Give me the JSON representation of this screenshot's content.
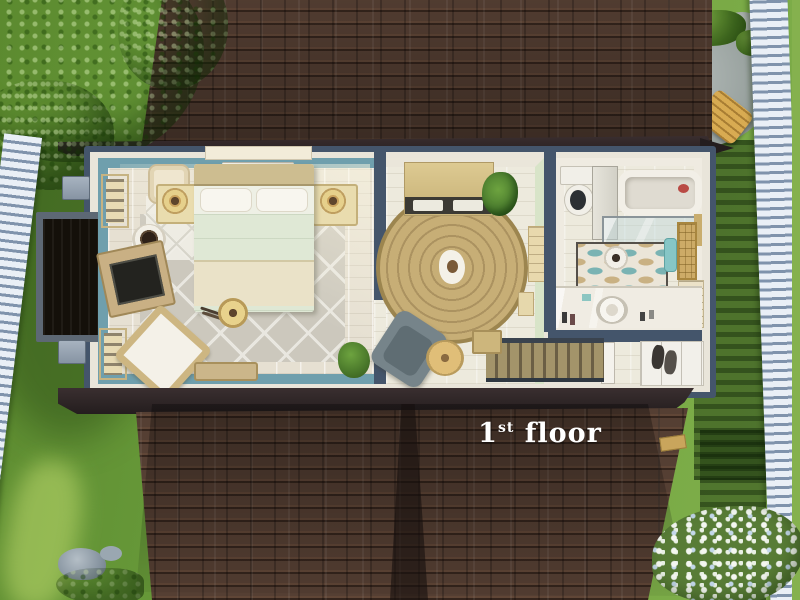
{
  "label": {
    "number": "1",
    "sup": "st",
    "word": " floor",
    "full_text": "1st floor"
  },
  "scene": {
    "description": "Top-down cutaway floorplan view of a house first floor in a life-sim game",
    "floor_shown": "1st floor"
  },
  "palette": {
    "roof_shingle": "#553f33",
    "roof_eave": "#2d2425",
    "grass": "#6f9e3a",
    "wall_cut_navy": "#44556b",
    "bedroom_wall_teal": "#6f9fad",
    "mint_wall": "#d8e4c8",
    "exterior_trim": "#e9e5da",
    "fence_white": "#e9eff6",
    "rug_tan": "#c7ae76",
    "stair_wood": "#9a8c60",
    "label_text": "#ffffff"
  },
  "rooms": [
    {
      "name": "bedroom",
      "wall_color": "#6f9fad",
      "objects": [
        "double-bed",
        "nightstand-left",
        "nightstand-right",
        "table-lamp-left",
        "table-lamp-right",
        "laundry-hamper",
        "wall-art-upper",
        "wall-art-lower",
        "pet-bed",
        "tv-console",
        "trellis-rug",
        "diamond-rug",
        "rocking-chair",
        "foot-bench",
        "floor-lamp",
        "chew-sticks",
        "potted-plant",
        "window-top"
      ]
    },
    {
      "name": "living-room",
      "wall_color": "#d8e4c8",
      "objects": [
        "dresser",
        "potted-palm",
        "round-braided-rug",
        "pet-toy",
        "armchair",
        "side-table",
        "interior-door",
        "picture-frame",
        "staircase",
        "newel-post"
      ]
    },
    {
      "name": "bathroom",
      "wall_color": "#efebe1",
      "objects": [
        "toilet",
        "storage-cabinet",
        "bathtub",
        "shower-glass-panel",
        "wave-rug",
        "toilet-paper-stand",
        "teal-towel",
        "back-door",
        "vanity-sink",
        "shelf-unit"
      ]
    },
    {
      "name": "entry-landing",
      "objects": [
        "front-door",
        "coat-closet",
        "coats"
      ]
    }
  ],
  "exterior": {
    "objects": [
      "tree-canopy",
      "picket-fence-left",
      "picket-fence-right",
      "stone-patio",
      "fire-pit",
      "fire-logs",
      "adirondack-chair",
      "wood-stool",
      "bushes",
      "boulder",
      "chimney",
      "utility-box-upper",
      "utility-box-lower",
      "rocks",
      "shrub",
      "flower-bed",
      "upper-roof",
      "lower-roof",
      "roof-valley",
      "gutter-end"
    ]
  }
}
